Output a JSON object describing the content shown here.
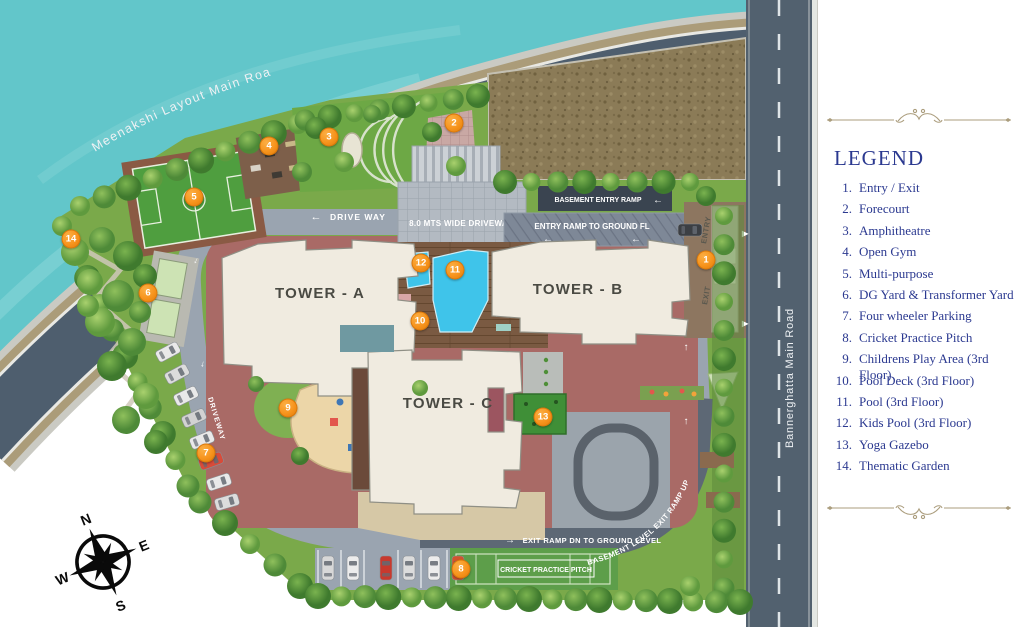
{
  "map": {
    "roads": {
      "meenakshi": "Meenakshi Layout Main Road",
      "bannerghatta": "Bannerghatta Main Road"
    },
    "labels": {
      "drive_way": "DRIVE WAY",
      "wide_driveway": "8.0 MTS WIDE DRIVEWAY",
      "basement_entry_ramp": "BASEMENT ENTRY RAMP",
      "entry_ramp_ground": "ENTRY RAMP TO GROUND FL",
      "exit_ramp_dn": "EXIT RAMP DN TO GROUND LEVEL",
      "basement_exit_ramp": "BASEMENT LEVEL EXIT RAMP UP",
      "driveway_left": "DRIVEWAY",
      "entry": "ENTRY",
      "exit": "EXIT",
      "cricket_pitch": "CRICKET PRACTICE PITCH"
    },
    "towers": {
      "a": "TOWER - A",
      "b": "TOWER - B",
      "c": "TOWER - C"
    },
    "compass": {
      "n": "N",
      "e": "E",
      "s": "S",
      "w": "W"
    },
    "icons": {
      "arrow_left": "←",
      "arrow_right": "→",
      "arrow_up": "↑",
      "arrow_down": "↓",
      "gate_arrow": "▶"
    },
    "markers": [
      {
        "n": "1"
      },
      {
        "n": "2"
      },
      {
        "n": "3"
      },
      {
        "n": "4"
      },
      {
        "n": "5"
      },
      {
        "n": "6"
      },
      {
        "n": "7"
      },
      {
        "n": "8"
      },
      {
        "n": "9"
      },
      {
        "n": "10"
      },
      {
        "n": "11"
      },
      {
        "n": "12"
      },
      {
        "n": "13"
      },
      {
        "n": "14"
      }
    ]
  },
  "legend": {
    "title": "LEGEND",
    "items": [
      {
        "num": "1.",
        "label": "Entry / Exit"
      },
      {
        "num": "2.",
        "label": "Forecourt"
      },
      {
        "num": "3.",
        "label": "Amphitheatre"
      },
      {
        "num": "4.",
        "label": "Open Gym"
      },
      {
        "num": "5.",
        "label": "Multi-purpose"
      },
      {
        "num": "6.",
        "label": "DG Yard & Transformer Yard"
      },
      {
        "num": "7.",
        "label": "Four wheeler Parking"
      },
      {
        "num": "8.",
        "label": "Cricket Practice Pitch"
      },
      {
        "num": "9.",
        "label": "Childrens Play Area (3rd Floor)"
      },
      {
        "num": "10.",
        "label": "Pool Deck (3rd Floor)"
      },
      {
        "num": "11.",
        "label": "Pool (3rd Floor)"
      },
      {
        "num": "12.",
        "label": "Kids Pool (3rd Floor)"
      },
      {
        "num": "13.",
        "label": "Yoga Gazebo"
      },
      {
        "num": "14.",
        "label": "Thematic Garden"
      }
    ]
  },
  "colors": {
    "water": "#62c6ca",
    "main_road": "#4e5e6e",
    "inner_driveway": "#9aa4b0",
    "marker_orange": "#f7941d",
    "legend_navy": "#2b3990",
    "pool_blue": "#3fc4ea",
    "court_green": "#4f9e3f",
    "site_green": "#7aa94a",
    "flourish_gold": "#ab9d7d"
  }
}
